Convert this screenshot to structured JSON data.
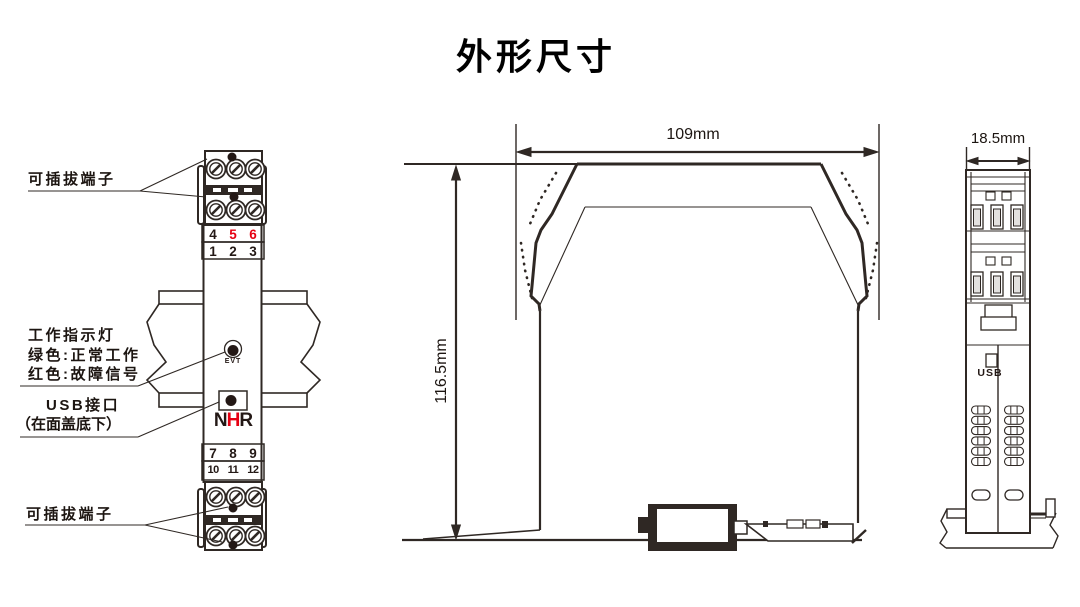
{
  "title": "外形尺寸",
  "colors": {
    "line": "#2f2824",
    "red": "#e60012",
    "black": "#231815"
  },
  "front_view": {
    "label_top_terminal": "可插拔端子",
    "label_bottom_terminal": "可插拔端子",
    "indicator_label_lines": [
      "工作指示灯",
      "绿色:正常工作",
      "红色:故障信号"
    ],
    "usb_label_lines": [
      "USB接口",
      "（在面盖底下）"
    ],
    "numbers_row1": [
      "4",
      "5",
      "6"
    ],
    "numbers_row2": [
      "1",
      "2",
      "3"
    ],
    "numbers_row3": [
      "7",
      "8",
      "9"
    ],
    "numbers_row4": [
      "10",
      "11",
      "12"
    ],
    "red_terminal_numbers": [
      "5",
      "6"
    ],
    "indicator_text": "EVT",
    "logo": [
      "N",
      "H",
      "R"
    ]
  },
  "side_view": {
    "width_dim": "109mm",
    "height_dim": "116.5mm"
  },
  "end_view": {
    "width_dim": "18.5mm",
    "usb_label": "USB"
  }
}
